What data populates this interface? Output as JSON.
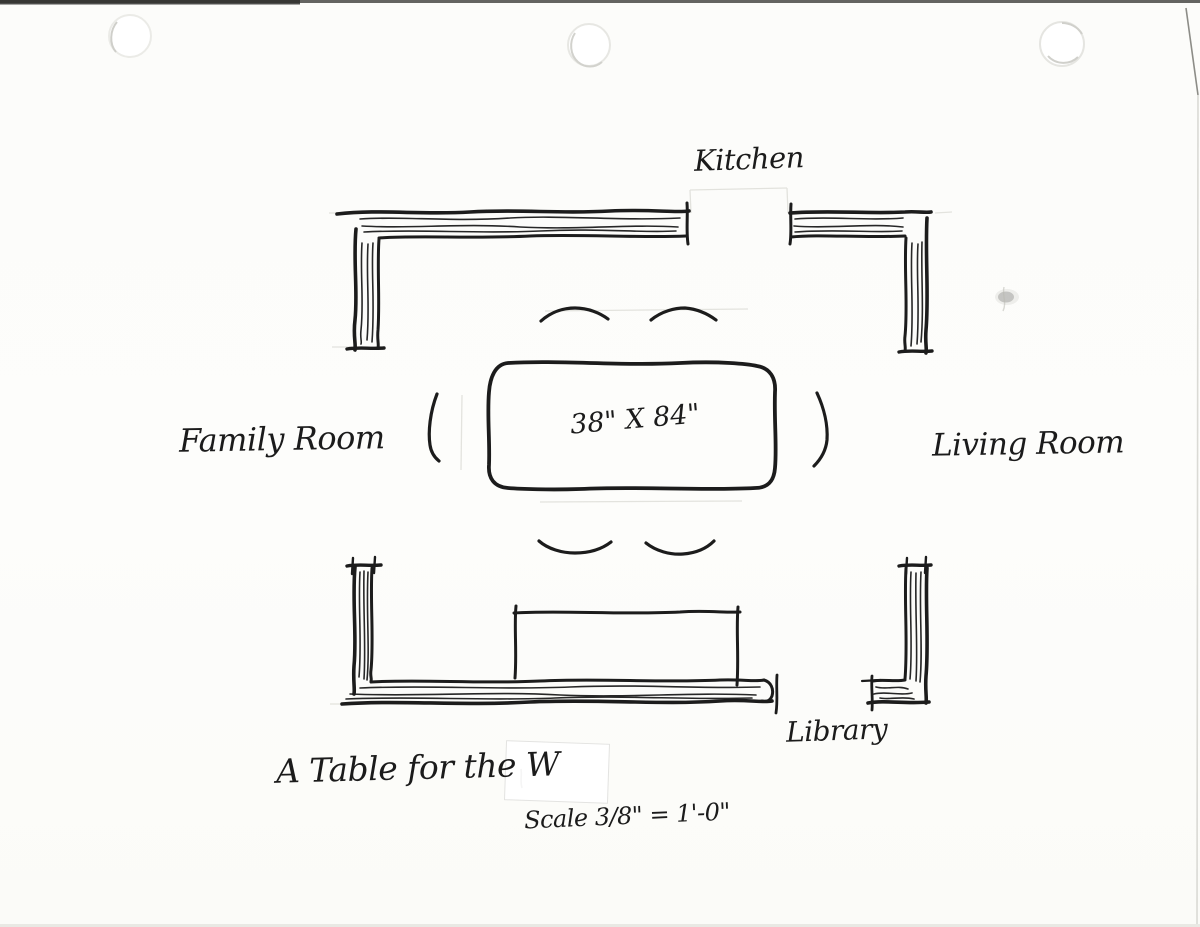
{
  "paper": {
    "background": "#fcfcfa",
    "ink_color": "#1c1c1c",
    "pencil_color": "#dededa"
  },
  "plan": {
    "rooms": {
      "kitchen": "Kitchen",
      "family_room": "Family Room",
      "living_room": "Living Room",
      "library": "Library"
    },
    "table_dimension": "38\" X 84\"",
    "title": "A Table for the W",
    "scale_note": "Scale 3/8\" = 1'-0\""
  }
}
